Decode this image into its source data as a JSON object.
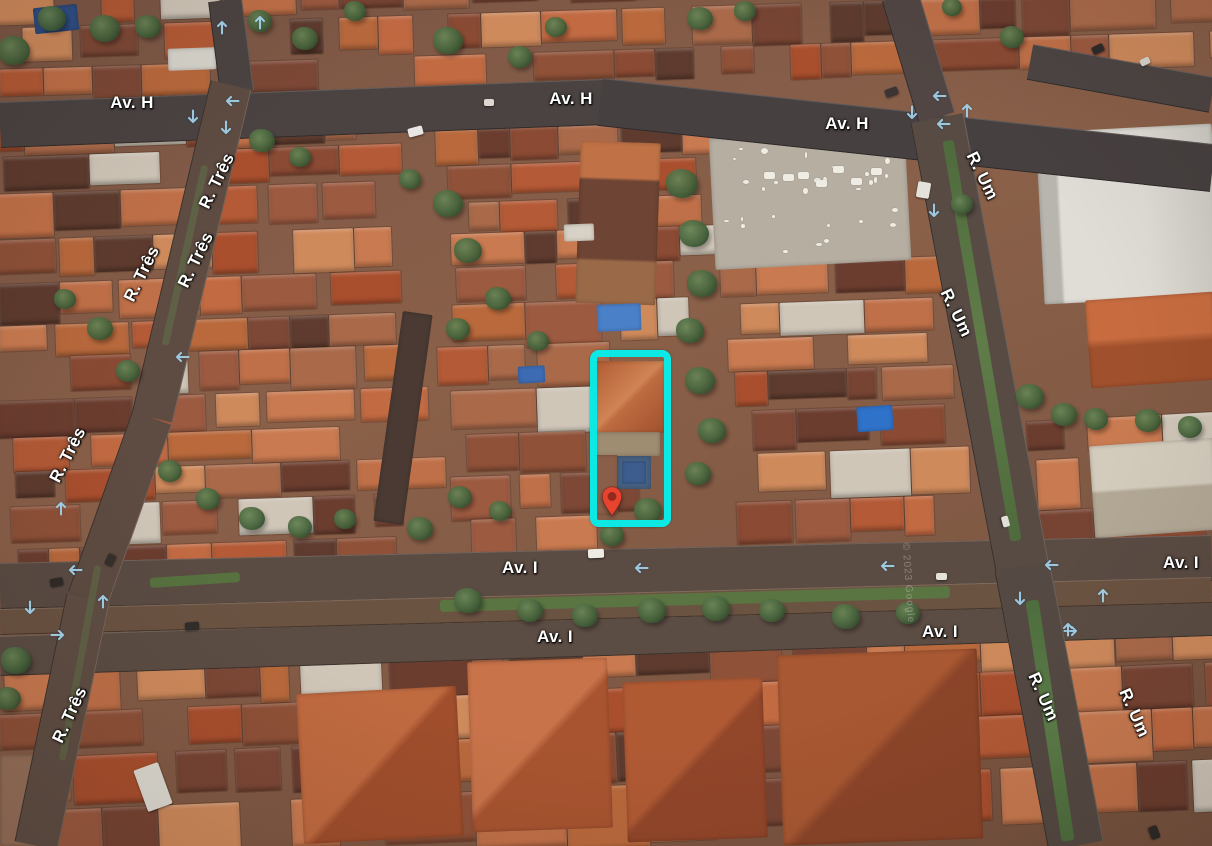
{
  "view": {
    "street_labels": [
      {
        "text": "Av. H",
        "x": 132,
        "y": 103,
        "rot": 0
      },
      {
        "text": "Av. H",
        "x": 571,
        "y": 99,
        "rot": 0
      },
      {
        "text": "Av. H",
        "x": 847,
        "y": 124,
        "rot": 0
      },
      {
        "text": "Av. I",
        "x": 520,
        "y": 568,
        "rot": 0
      },
      {
        "text": "Av. I",
        "x": 555,
        "y": 637,
        "rot": 0
      },
      {
        "text": "Av. I",
        "x": 940,
        "y": 632,
        "rot": 0
      },
      {
        "text": "Av. I",
        "x": 1181,
        "y": 563,
        "rot": 0
      },
      {
        "text": "R. Três",
        "x": 217,
        "y": 181,
        "rot": -64
      },
      {
        "text": "R. Três",
        "x": 196,
        "y": 260,
        "rot": -64
      },
      {
        "text": "R. Três",
        "x": 142,
        "y": 274,
        "rot": -64
      },
      {
        "text": "R. Três",
        "x": 68,
        "y": 455,
        "rot": -63
      },
      {
        "text": "R. Três",
        "x": 70,
        "y": 715,
        "rot": -65
      },
      {
        "text": "R. Um",
        "x": 982,
        "y": 176,
        "rot": 64
      },
      {
        "text": "R. Um",
        "x": 956,
        "y": 313,
        "rot": 64
      },
      {
        "text": "R. Um",
        "x": 1043,
        "y": 697,
        "rot": 66
      },
      {
        "text": "R. Um",
        "x": 1134,
        "y": 713,
        "rot": 66
      }
    ],
    "direction_arrows": [
      {
        "x": 233,
        "y": 101,
        "rot": -90
      },
      {
        "x": 193,
        "y": 116,
        "rot": 180
      },
      {
        "x": 226,
        "y": 127,
        "rot": 180
      },
      {
        "x": 222,
        "y": 28,
        "rot": 0
      },
      {
        "x": 260,
        "y": 23,
        "rot": 0
      },
      {
        "x": 940,
        "y": 96,
        "rot": -90
      },
      {
        "x": 912,
        "y": 112,
        "rot": 180
      },
      {
        "x": 967,
        "y": 111,
        "rot": 0
      },
      {
        "x": 944,
        "y": 124,
        "rot": -90
      },
      {
        "x": 934,
        "y": 210,
        "rot": 180
      },
      {
        "x": 642,
        "y": 568,
        "rot": -90
      },
      {
        "x": 888,
        "y": 566,
        "rot": -90
      },
      {
        "x": 1052,
        "y": 565,
        "rot": -90
      },
      {
        "x": 1020,
        "y": 598,
        "rot": 180
      },
      {
        "x": 1103,
        "y": 596,
        "rot": 0
      },
      {
        "x": 1070,
        "y": 631,
        "rot": 90
      },
      {
        "x": 61,
        "y": 509,
        "rot": 0
      },
      {
        "x": 76,
        "y": 570,
        "rot": -90
      },
      {
        "x": 30,
        "y": 607,
        "rot": 180
      },
      {
        "x": 57,
        "y": 635,
        "rot": 90
      },
      {
        "x": 103,
        "y": 602,
        "rot": 0
      },
      {
        "x": 183,
        "y": 357,
        "rot": -90
      },
      {
        "x": 1068,
        "y": 630,
        "rot": 0
      }
    ],
    "watermark": {
      "text": "© 2023 Google",
      "x": 908,
      "y": 583,
      "rot": 86
    },
    "highlight_box": {
      "x": 590,
      "y": 350,
      "width": 81,
      "height": 177,
      "border_width": 7,
      "corner_radius": 9,
      "color": "#0ce9e4"
    },
    "marker_pin": {
      "tip_x": 612,
      "tip_y": 518,
      "width": 22,
      "height": 33,
      "color": "#e8432f",
      "dot_color": "#932a1c"
    },
    "arrow_color": "#a5d5ee",
    "label_color": "#ffffff"
  }
}
